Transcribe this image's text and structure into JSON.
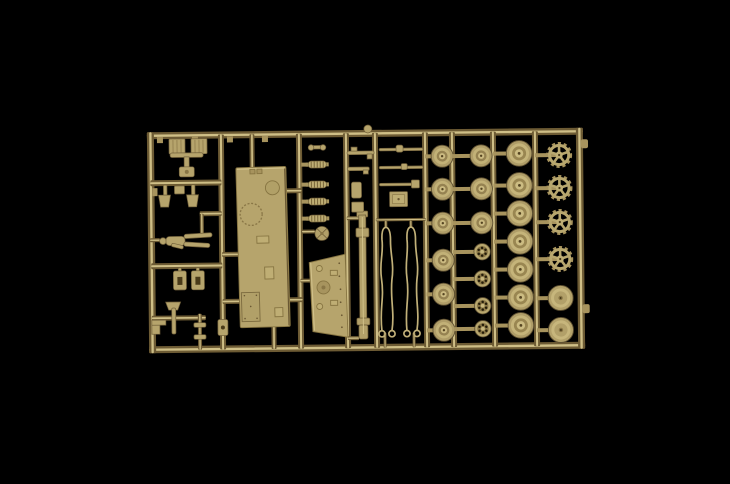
{
  "meta": {
    "type": "photograph",
    "alt": "Overhead photograph of a sand-coloured injection-moulded model kit sprue holding tank road wheels, drive sprockets, hull panels, suspension springs, tools, tow cables and a crew figure, lit against a pure black background."
  },
  "colors": {
    "background": "#000000",
    "runner_dark": "#6e5b32",
    "runner_mid": "#a8935b",
    "runner_light": "#d0bf85",
    "part": "#b7a46a",
    "part_light": "#cbb97e",
    "part_dark": "#8a7644",
    "shadow": "#4a3a18",
    "hole": "#1c1504"
  },
  "sprue": {
    "frame": {
      "x": 148,
      "y": 130,
      "w": 436,
      "h": 221,
      "t": 7
    },
    "tilt_deg": -0.6,
    "v_runners": [
      {
        "x": 222
      },
      {
        "x": 300
      },
      {
        "x": 347
      },
      {
        "x": 376
      },
      {
        "x": 426
      },
      {
        "x": 453
      },
      {
        "x": 494
      },
      {
        "x": 536
      }
    ],
    "h_runners": [
      {
        "y": 181,
        "x1": 151,
        "x2": 222,
        "t": 6
      },
      {
        "y": 212,
        "x1": 200,
        "x2": 222,
        "t": 5
      },
      {
        "y": 264,
        "x1": 151,
        "x2": 222,
        "t": 6
      },
      {
        "y": 316,
        "x1": 151,
        "x2": 205,
        "t": 5
      },
      {
        "y": 253,
        "x1": 222,
        "x2": 242,
        "t": 5
      },
      {
        "y": 300,
        "x1": 222,
        "x2": 242,
        "t": 5
      },
      {
        "y": 190,
        "x1": 284,
        "x2": 302,
        "t": 5
      },
      {
        "y": 299,
        "x1": 284,
        "x2": 302,
        "t": 5
      },
      {
        "y": 220,
        "x1": 376,
        "x2": 426,
        "t": 3
      },
      {
        "y": 218,
        "x1": 347,
        "x2": 360,
        "t": 4
      },
      {
        "y": 338,
        "x1": 347,
        "x2": 358,
        "t": 4
      },
      {
        "y": 280,
        "x1": 300,
        "x2": 311,
        "t": 4
      },
      {
        "y": 231,
        "x1": 302,
        "x2": 315,
        "t": 4
      },
      {
        "y": 238,
        "x1": 150,
        "x2": 160,
        "t": 4
      }
    ],
    "v_stubs": [
      {
        "x": 253,
        "y1": 133,
        "y2": 168,
        "t": 5
      },
      {
        "x": 273,
        "y1": 324,
        "y2": 348,
        "t": 5
      },
      {
        "x": 202,
        "y1": 212,
        "y2": 232,
        "t": 4
      },
      {
        "x": 199,
        "y1": 312,
        "y2": 348,
        "t": 4
      },
      {
        "x": 384,
        "y1": 333,
        "y2": 348,
        "t": 3
      },
      {
        "x": 413,
        "y1": 333,
        "y2": 348,
        "t": 3
      },
      {
        "x": 386,
        "y1": 221,
        "y2": 228,
        "t": 3
      },
      {
        "x": 411,
        "y1": 221,
        "y2": 228,
        "t": 3
      }
    ],
    "top_tabs_x": [
      161,
      196,
      231,
      266
    ],
    "left_nubs_y": [
      190
    ],
    "right_nubs_y": [
      146,
      311
    ],
    "sprue_gate_blob": {
      "x": 369,
      "y": 129,
      "r": 4
    },
    "springs": {
      "x": 318,
      "stub_x": 302,
      "ys": [
        164,
        184,
        201,
        218
      ]
    },
    "wheel_columns": [
      {
        "x": 443,
        "stub_from": 426,
        "parts": [
          {
            "t": "road",
            "y": 157
          },
          {
            "t": "road",
            "y": 190
          },
          {
            "t": "road",
            "y": 224
          },
          {
            "t": "road",
            "y": 261
          },
          {
            "t": "road",
            "y": 295
          },
          {
            "t": "road",
            "y": 331
          }
        ]
      },
      {
        "x": 482,
        "stub_from": 453,
        "parts": [
          {
            "t": "road",
            "y": 157
          },
          {
            "t": "road",
            "y": 190
          },
          {
            "t": "road",
            "y": 224
          },
          {
            "t": "spoke",
            "y": 253
          },
          {
            "t": "spoke",
            "y": 280
          },
          {
            "t": "spoke",
            "y": 307
          },
          {
            "t": "spoke",
            "y": 330
          }
        ]
      },
      {
        "x": 520,
        "stub_from": 494,
        "parts": [
          {
            "t": "big",
            "y": 155
          },
          {
            "t": "big",
            "y": 187
          },
          {
            "t": "big",
            "y": 215
          },
          {
            "t": "big",
            "y": 243
          },
          {
            "t": "big",
            "y": 271
          },
          {
            "t": "big",
            "y": 299
          },
          {
            "t": "big",
            "y": 327
          }
        ]
      },
      {
        "x": 560,
        "stub_from": 536,
        "parts": [
          {
            "t": "sprocket",
            "y": 157
          },
          {
            "t": "sprocket",
            "y": 190
          },
          {
            "t": "sprocket",
            "y": 224
          },
          {
            "t": "sprocket",
            "y": 261
          },
          {
            "t": "drum",
            "y": 300
          },
          {
            "t": "drum",
            "y": 332
          }
        ]
      }
    ],
    "part_counts": {
      "road_wheels": 9,
      "large_wheels": 7,
      "spoked_rollers": 4,
      "drive_sprockets": 4,
      "drum_wheels": 2,
      "suspension_springs": 4,
      "tow_cables": 2,
      "crew_figures": 1,
      "hull_panels": 2,
      "gun_barrels": 1
    }
  }
}
